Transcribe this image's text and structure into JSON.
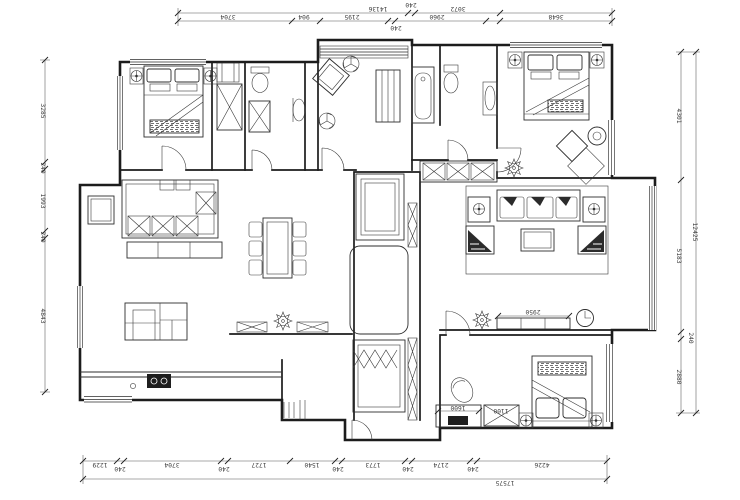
{
  "drawing": {
    "type": "residential-floor-plan",
    "dims": {
      "top_outer": [
        "14136",
        "240",
        "3072"
      ],
      "top_inner": [
        "3704",
        "904",
        "2195",
        "240",
        "2960",
        "3648"
      ],
      "left": [
        "3285",
        "240",
        "1993",
        "240",
        "4843"
      ],
      "right_inner": [
        "4301",
        "5183",
        "240",
        "2880"
      ],
      "right_total": "12425",
      "bottom_inner": [
        "1229",
        "240",
        "3704",
        "240",
        "1727",
        "1540",
        "240",
        "1773",
        "240",
        "2174",
        "240",
        "4226"
      ],
      "bottom_total": "17575"
    },
    "labels": {
      "tv_cabinet": "2950",
      "desk": "1600",
      "wardrobe": "1100"
    }
  }
}
